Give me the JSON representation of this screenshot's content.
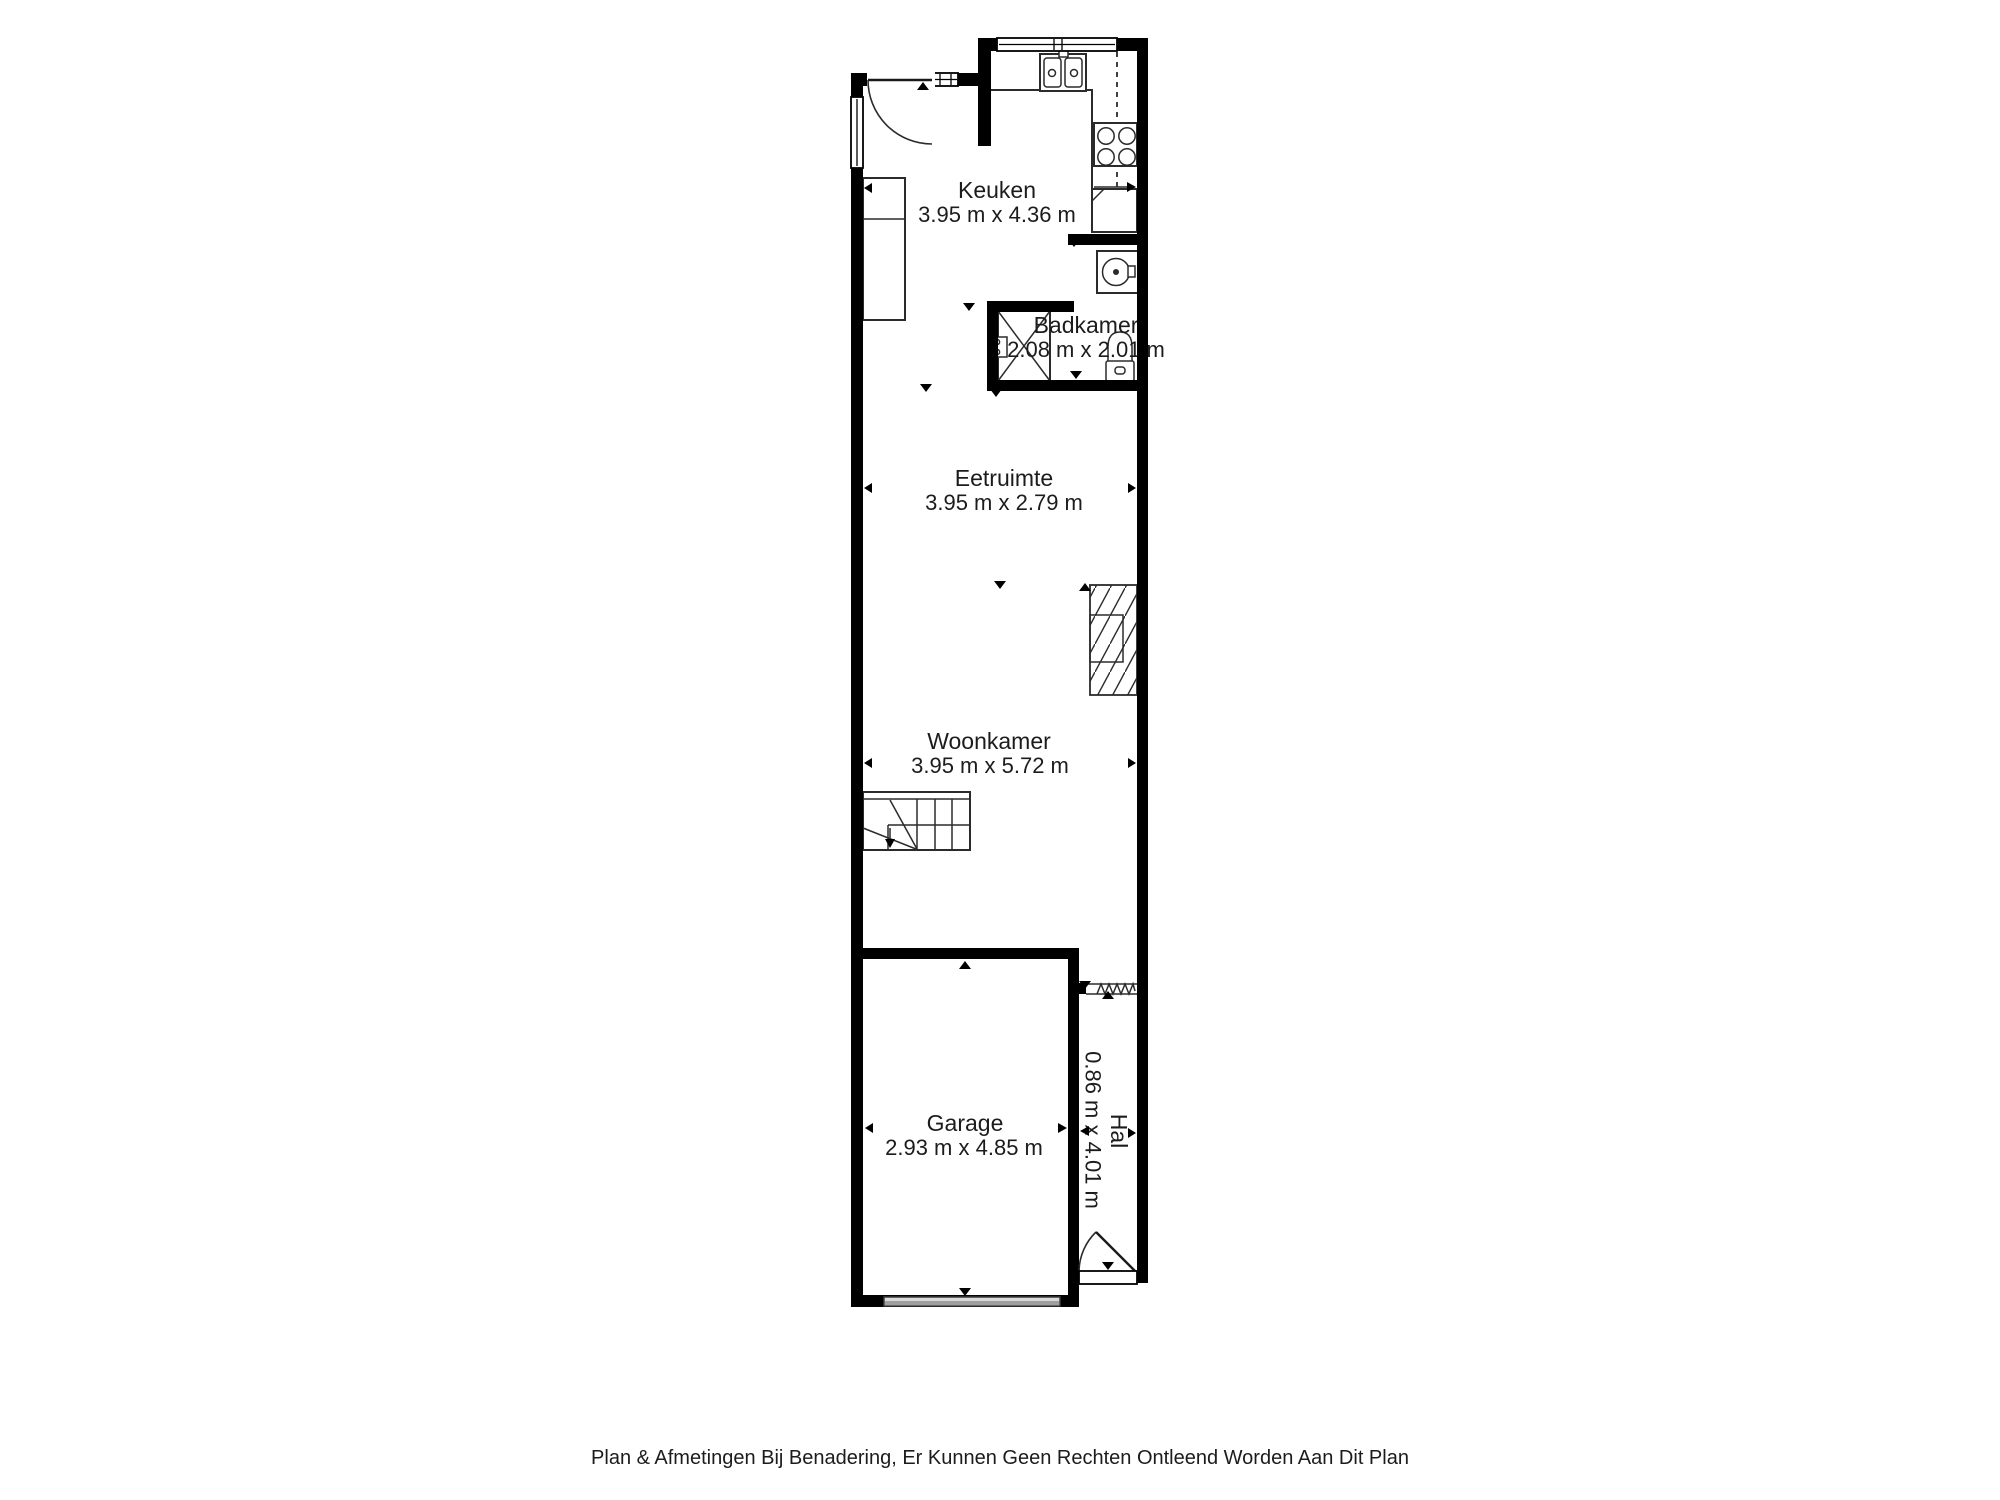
{
  "rooms": [
    {
      "name": "Keuken",
      "dims": "3.95 m x 4.36 m"
    },
    {
      "name": "Badkamer",
      "dims": "2.08 m x 2.01 m"
    },
    {
      "name": "Eetruimte",
      "dims": "3.95 m x 2.79 m"
    },
    {
      "name": "Woonkamer",
      "dims": "3.95 m x 5.72 m"
    },
    {
      "name": "Garage",
      "dims": "2.93 m x 4.85 m"
    },
    {
      "name": "Hal",
      "dims": "0.86 m x 4.01 m"
    }
  ],
  "disclaimer": "Plan & Afmetingen Bij Benadering, Er Kunnen Geen Rechten Ontleend Worden Aan Dit Plan",
  "icons": {
    "kitchen_sink": "double-sink-icon",
    "stove": "four-burner-stove-icon",
    "washing_machine": "washing-machine-icon",
    "shower": "shower-icon",
    "toilet": "toilet-icon",
    "stairs_down": "staircase-icon",
    "stairs_up": "hatched-staircase-icon",
    "doors": "door-swing-icon"
  },
  "colors": {
    "wall": "#000000",
    "fixture_line": "#2b2b2b",
    "text": "#1c1c1c",
    "garage_door_fill": "#d9d9d9",
    "garage_door_shade": "#9f9f9f",
    "background": "#ffffff"
  }
}
